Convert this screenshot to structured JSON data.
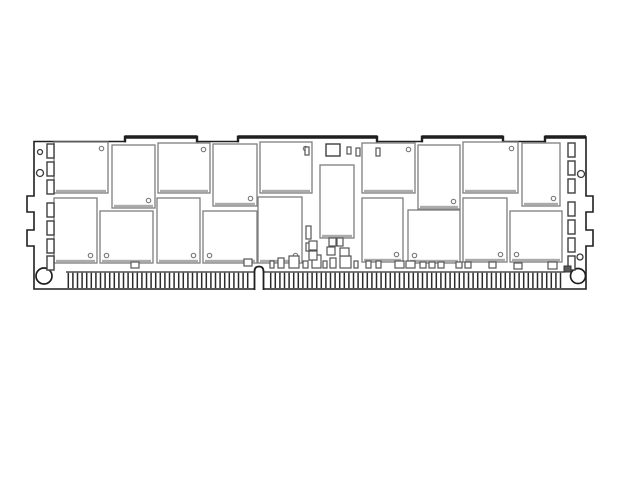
{
  "colors": {
    "background": "#ffffff",
    "outline": "#1f1f1f",
    "chip_border": "#7e7e7e",
    "chip_shadow": "#ababab",
    "passive_border": "#3f3f3f",
    "finger_line": "#2a2a2a",
    "hole_border": "#3a3a3a",
    "fill": "#ffffff",
    "dark_component": "#5a5a5a"
  },
  "diagram": {
    "canvas": {
      "width": 640,
      "height": 480
    },
    "board": {
      "left": 34,
      "right": 586,
      "top_high": 137,
      "top_low": 141.5,
      "bottom": 289
    },
    "top_edge_segments": [
      {
        "from": 34,
        "to": 125,
        "level": "low"
      },
      {
        "from": 125,
        "to": 197,
        "level": "high"
      },
      {
        "from": 197,
        "to": 238,
        "level": "low"
      },
      {
        "from": 238,
        "to": 377,
        "level": "high"
      },
      {
        "from": 377,
        "to": 422,
        "level": "low"
      },
      {
        "from": 422,
        "to": 503,
        "level": "high"
      },
      {
        "from": 503,
        "to": 545,
        "level": "low"
      },
      {
        "from": 545,
        "to": 586,
        "level": "high"
      }
    ],
    "side_tabs": {
      "depth": 7,
      "spans": [
        [
          196,
          212
        ],
        [
          230,
          246
        ]
      ]
    },
    "holes": [
      {
        "side": "left",
        "cx": 40,
        "cy": 152,
        "r": 2.5
      },
      {
        "side": "left",
        "cx": 40,
        "cy": 173,
        "r": 3.5
      },
      {
        "side": "left",
        "cx": 44,
        "cy": 276,
        "r": 8
      },
      {
        "side": "right",
        "cx": 581,
        "cy": 174,
        "r": 3.5
      },
      {
        "side": "right",
        "cx": 580,
        "cy": 257,
        "r": 3
      },
      {
        "side": "right",
        "cx": 578,
        "cy": 276,
        "r": 7.5
      }
    ],
    "memory_chips": [
      {
        "x": 54,
        "y": 142,
        "w": 54,
        "h": 51,
        "dot": "tr"
      },
      {
        "x": 112,
        "y": 145,
        "w": 43,
        "h": 63,
        "dot": "br"
      },
      {
        "x": 158,
        "y": 143,
        "w": 52,
        "h": 50,
        "dot": "tr"
      },
      {
        "x": 213,
        "y": 144,
        "w": 44,
        "h": 62,
        "dot": "br"
      },
      {
        "x": 260,
        "y": 142,
        "w": 52,
        "h": 51,
        "dot": "tr"
      },
      {
        "x": 362,
        "y": 143,
        "w": 53,
        "h": 50,
        "dot": "tr"
      },
      {
        "x": 418,
        "y": 145,
        "w": 42,
        "h": 64,
        "dot": "br"
      },
      {
        "x": 463,
        "y": 142,
        "w": 55,
        "h": 51,
        "dot": "tr"
      },
      {
        "x": 522,
        "y": 143,
        "w": 38,
        "h": 63,
        "dot": "br"
      },
      {
        "x": 54,
        "y": 198,
        "w": 43,
        "h": 65,
        "dot": "br"
      },
      {
        "x": 100,
        "y": 211,
        "w": 53,
        "h": 52,
        "dot": "bl"
      },
      {
        "x": 157,
        "y": 198,
        "w": 43,
        "h": 65,
        "dot": "br"
      },
      {
        "x": 203,
        "y": 211,
        "w": 54,
        "h": 52,
        "dot": "bl"
      },
      {
        "x": 258,
        "y": 197,
        "w": 44,
        "h": 66,
        "dot": "br"
      },
      {
        "x": 362,
        "y": 198,
        "w": 41,
        "h": 64,
        "dot": "br"
      },
      {
        "x": 408,
        "y": 210,
        "w": 52,
        "h": 53,
        "dot": "bl"
      },
      {
        "x": 463,
        "y": 198,
        "w": 44,
        "h": 64,
        "dot": "br"
      },
      {
        "x": 510,
        "y": 211,
        "w": 52,
        "h": 51,
        "dot": "bl"
      }
    ],
    "register_chip": {
      "x": 320,
      "y": 165,
      "w": 34,
      "h": 73
    },
    "spd_eeprom": {
      "x": 326,
      "y": 144,
      "w": 14,
      "h": 12
    },
    "side_passives": {
      "left_x": 47,
      "right_x": 568,
      "w": 7,
      "h": 14,
      "left_ys": [
        144,
        162,
        180,
        203,
        221,
        239,
        256
      ],
      "right_ys": [
        143,
        161,
        179,
        202,
        220,
        238,
        256
      ]
    },
    "dark_component": {
      "x": 564,
      "y": 266,
      "w": 7,
      "h": 6
    },
    "small_passives": [
      [
        131,
        262,
        8,
        6
      ],
      [
        244,
        259,
        8,
        7
      ],
      [
        270,
        261,
        4,
        7
      ],
      [
        278,
        258,
        6,
        10
      ],
      [
        289,
        256,
        10,
        12
      ],
      [
        303,
        261,
        5,
        7
      ],
      [
        312,
        255,
        9,
        13
      ],
      [
        323,
        261,
        4,
        7
      ],
      [
        330,
        258,
        6,
        10
      ],
      [
        340,
        256,
        11,
        12
      ],
      [
        354,
        261,
        4,
        7
      ],
      [
        366,
        261,
        5,
        7
      ],
      [
        376,
        261,
        5,
        7
      ],
      [
        395,
        261,
        9,
        7
      ],
      [
        406,
        261,
        9,
        7
      ],
      [
        420,
        262,
        6,
        6
      ],
      [
        429,
        262,
        6,
        6
      ],
      [
        438,
        262,
        6,
        6
      ],
      [
        456,
        262,
        6,
        6
      ],
      [
        465,
        262,
        6,
        6
      ],
      [
        489,
        262,
        7,
        6
      ],
      [
        514,
        263,
        8,
        6
      ],
      [
        548,
        262,
        9,
        7
      ],
      [
        306,
        226,
        5,
        13
      ],
      [
        306,
        243,
        5,
        8
      ],
      [
        309,
        241,
        8,
        9
      ],
      [
        309,
        251,
        8,
        9
      ],
      [
        329,
        238,
        7,
        8
      ],
      [
        337,
        238,
        6,
        8
      ],
      [
        327,
        247,
        8,
        8
      ],
      [
        340,
        248,
        9,
        8
      ],
      [
        305,
        147,
        4,
        8
      ],
      [
        347,
        147,
        4,
        7
      ],
      [
        356,
        148,
        4,
        8
      ],
      [
        376,
        148,
        4,
        8
      ]
    ],
    "edge_connector": {
      "x1": 66,
      "x2": 565,
      "top": 272,
      "bottom": 288,
      "pitch": 4.6,
      "key_notch": {
        "x1": 254.5,
        "x2": 263.5,
        "top": 266.5,
        "radius": 5
      }
    }
  }
}
